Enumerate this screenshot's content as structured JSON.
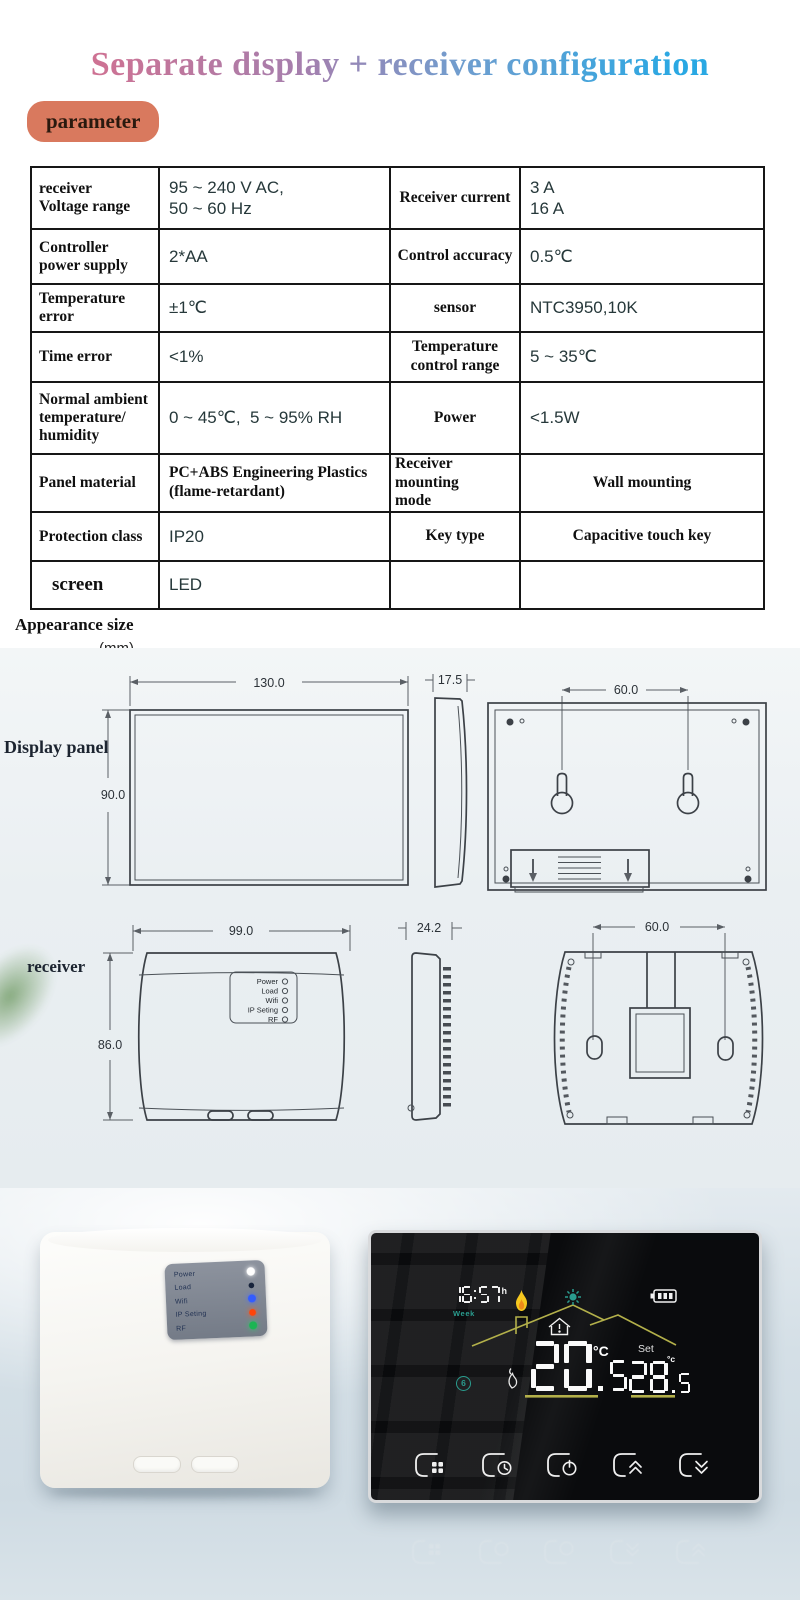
{
  "header": {
    "title": "Separate display + receiver configuration",
    "badge": "parameter"
  },
  "spec_table": {
    "rows": [
      {
        "c1": "receiver\nVoltage range",
        "c2": "95 ~ 240 V AC,\n50 ~ 60 Hz",
        "c3": "Receiver current",
        "c4": "3 A\n16 A"
      },
      {
        "c1": "Controller\npower supply",
        "c2": "2*AA",
        "c3": "Control accuracy",
        "c4": "0.5℃"
      },
      {
        "c1": "Temperature\nerror",
        "c2": "±1℃",
        "c3": "sensor",
        "c4": "NTC3950,10K"
      },
      {
        "c1": "Time error",
        "c2": "<1%",
        "c3": "Temperature\ncontrol range",
        "c4": "5 ~ 35℃"
      },
      {
        "c1": "Normal ambient\ntemperature/\nhumidity",
        "c2": "0 ~ 45℃,  5 ~ 95% RH",
        "c3": "Power",
        "c4": "<1.5W"
      },
      {
        "c1": "Panel material",
        "c2": "PC+ABS Engineering Plastics\n(flame-retardant)",
        "c3": "Receiver mounting\nmode",
        "c4": "Wall mounting"
      },
      {
        "c1": "Protection class",
        "c2": "IP20",
        "c3": "Key type",
        "c4": "Capacitive touch key"
      },
      {
        "c1": "screen",
        "c2": "LED",
        "c3": "",
        "c4": ""
      }
    ]
  },
  "appearance": {
    "heading": "Appearance size",
    "unit": "(mm)"
  },
  "display_panel": {
    "label": "Display panel",
    "dim_width": "130.0",
    "dim_height": "90.0",
    "dim_depth": "17.5",
    "dim_mount": "60.0"
  },
  "receiver_drawing": {
    "label": "receiver",
    "dim_width": "99.0",
    "dim_height": "86.0",
    "dim_depth": "24.2",
    "dim_mount": "60.0",
    "led_labels": [
      "Power",
      "Load",
      "Wifi",
      "IP Seting",
      "RF"
    ]
  },
  "receiver_photo": {
    "led_rows": [
      {
        "label": "Power",
        "state": "on"
      },
      {
        "label": "Load",
        "state": "off"
      },
      {
        "label": "Wifi",
        "state": "on"
      },
      {
        "label": "IP Seting",
        "state": "on"
      },
      {
        "label": "RF",
        "state": "on"
      }
    ]
  },
  "thermostat": {
    "time": "16:57",
    "time_suffix": "h",
    "week": "Week",
    "room_temp": "20.5",
    "room_unit": "°C",
    "set_label": "Set",
    "set_temp": "28.5",
    "set_unit": "°c",
    "mode_number": "6",
    "buttons": [
      {
        "icon": "menu-grid"
      },
      {
        "icon": "clock"
      },
      {
        "icon": "power"
      },
      {
        "icon": "chevrons-up"
      },
      {
        "icon": "chevrons-down"
      }
    ],
    "screen_icons": [
      "flame",
      "sun",
      "battery",
      "house-roof",
      "room-house",
      "eco-circle"
    ]
  },
  "colors": {
    "title_start": "#d4708f",
    "title_end": "#29a8e3",
    "badge_bg": "#d9795e",
    "teal": "#2a9d8f",
    "olive": "#b3b04a",
    "flame_yellow": "#f6c81f",
    "flame_orange": "#ef8b1a",
    "led_power": "#ffffff",
    "led_load": "#17233c",
    "led_wifi": "#335cff",
    "led_ip": "#ff4408",
    "led_rf": "#1cb553"
  }
}
